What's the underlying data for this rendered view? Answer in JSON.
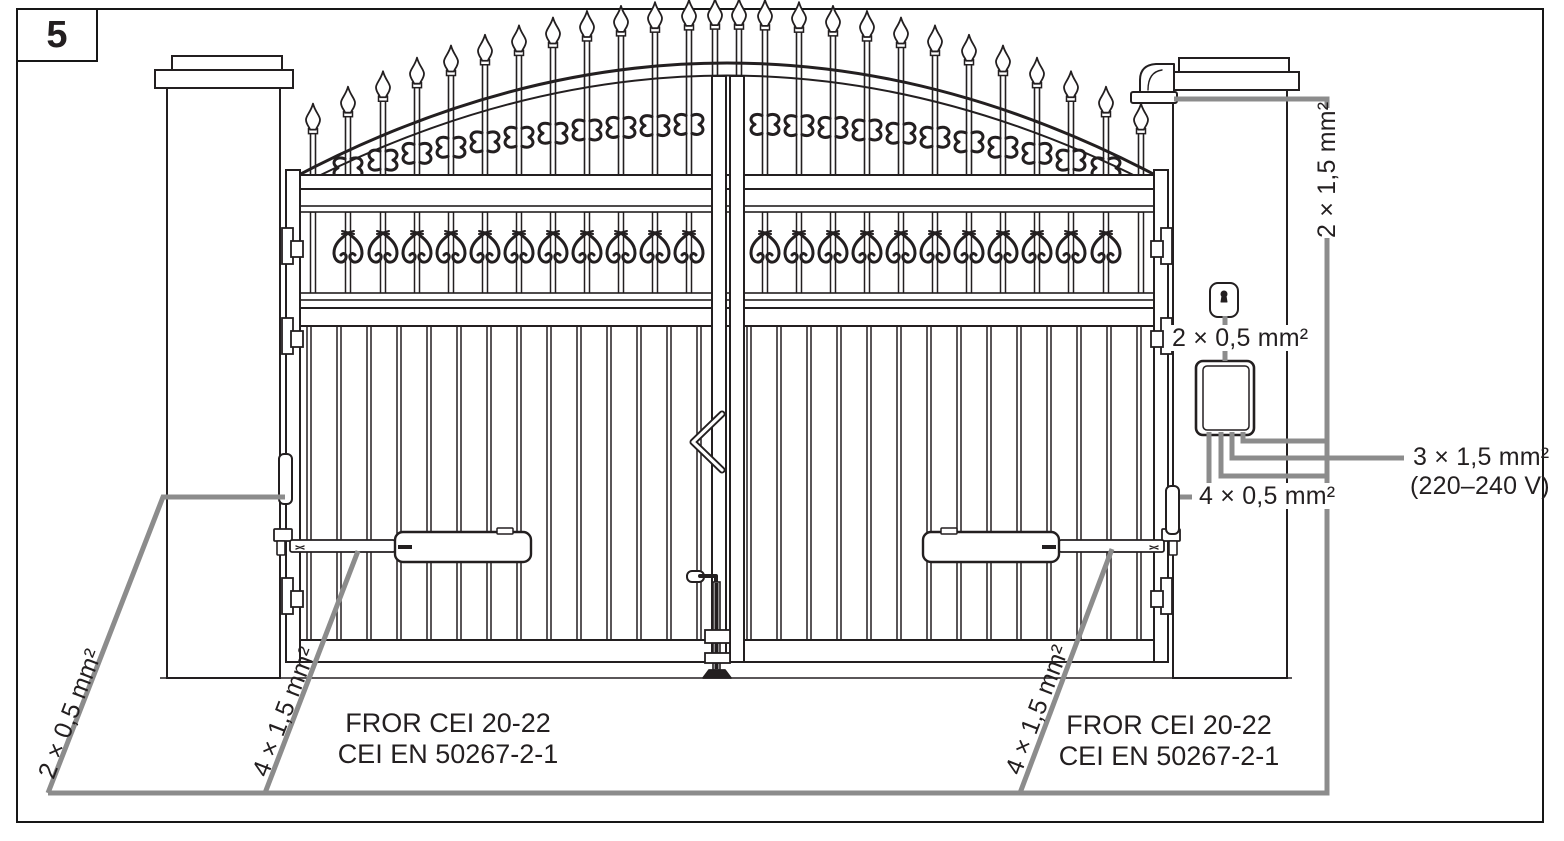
{
  "figure_number": "5",
  "labels": {
    "flasher_cable": "2 × 1,5 mm²",
    "keyswitch_cable": "2 × 0,5 mm²",
    "power_cable": "3 × 1,5 mm²",
    "power_voltage": "(220–240 V)",
    "photocell_cable": "4 × 0,5 mm²",
    "photocell_pair_cable": "2 × 0,5 mm²",
    "motor_cable_left": "4 × 1,5 mm²",
    "motor_cable_right": "4 × 1,5 mm²",
    "cable_spec_left_line1": "FROR CEI 20-22",
    "cable_spec_left_line2": "CEI EN 50267-2-1",
    "cable_spec_right_line1": "FROR CEI 20-22",
    "cable_spec_right_line2": "CEI EN 50267-2-1"
  },
  "colors": {
    "ink": "#231f20",
    "wire": "#8c8c8c",
    "background": "#ffffff"
  }
}
